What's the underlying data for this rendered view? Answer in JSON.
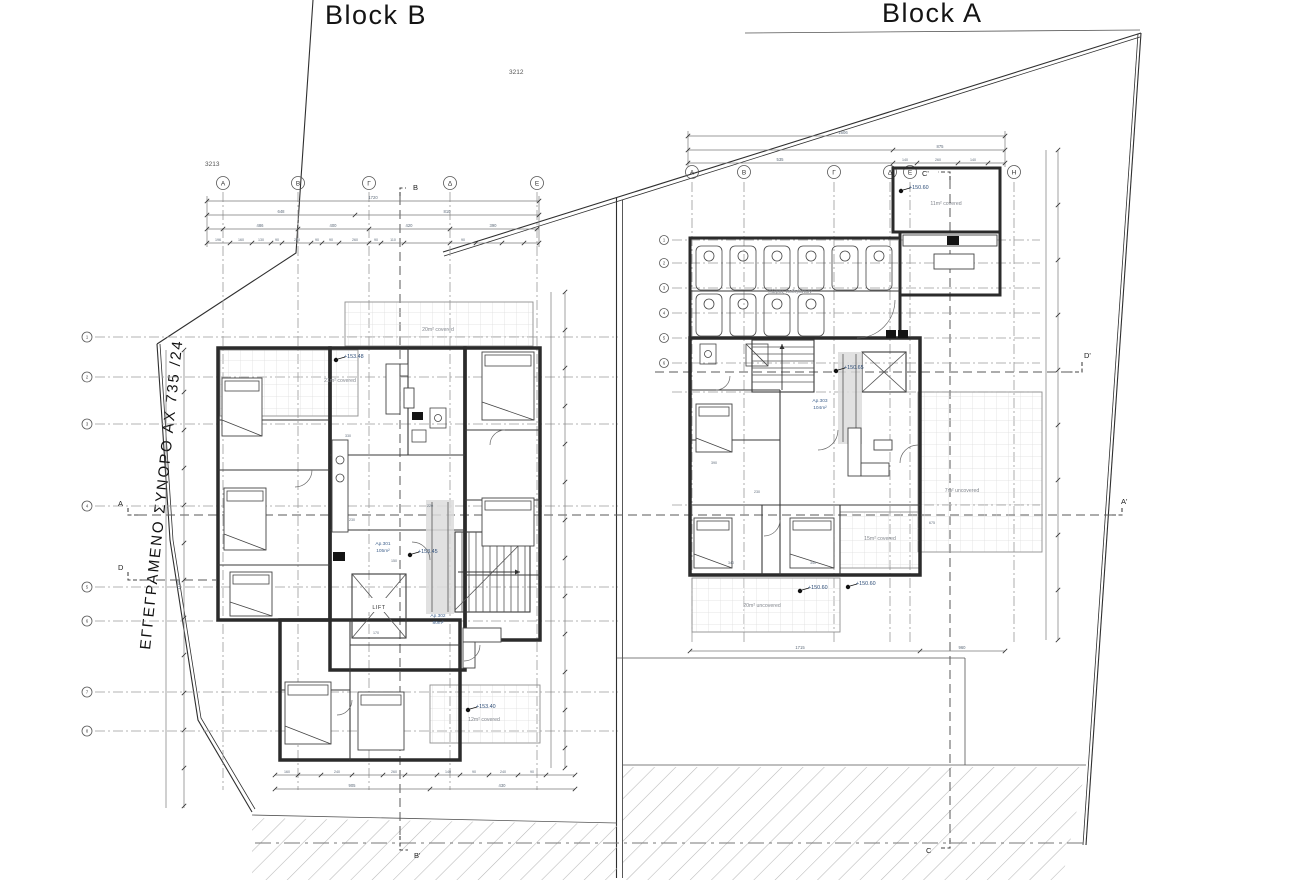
{
  "colors": {
    "paper": "#ffffff",
    "wall": "#2b2b2b",
    "grid_line": "#9a9a9a",
    "tile_line": "#dcdcdc",
    "road_hatch": "#b8b8b8",
    "dim_text": "#5f6c7b",
    "annotation_blue": "#2e4d77",
    "area_text": "#82868d"
  },
  "titles": {
    "block_b": "Block B",
    "block_a": "Block A"
  },
  "survey": {
    "p1": "3212",
    "p2": "3213"
  },
  "site": {
    "boundary_label": "ΕΓΓΕΓΡΑΜΕΝΟ ΣΥΝΟΡΟ ΑΧ 735 /24"
  },
  "sections": {
    "b": "B",
    "b_prime": "B'",
    "a": "A",
    "a_prime": "A'",
    "c": "C",
    "c_prime": "C'",
    "d": "D",
    "d_prime": "D'"
  },
  "block_b": {
    "grid_letters": [
      "Α",
      "Β",
      "Γ",
      "Δ",
      "Ε"
    ],
    "row_numbers": [
      "1",
      "2",
      "3",
      "4",
      "5",
      "6",
      "7",
      "8"
    ],
    "lift": "LIFT",
    "levels": {
      "balcony_top": "+153.48",
      "entry": "+153.45",
      "balcony_bottom": "+153.40"
    },
    "areas": {
      "balcony_20": "20m² covered",
      "balcony_21": "21m² covered",
      "balcony_12": "12m² covered"
    },
    "apartments": {
      "ap1_name": "Ap.301",
      "ap1_area": "105m²",
      "ap2_name": "Ap.302",
      "ap2_area": "80m²"
    },
    "dims": {
      "total": "1720",
      "row2": [
        "648",
        "810"
      ],
      "row3": [
        "486",
        "400",
        "420",
        "390"
      ],
      "row4": [
        "196",
        "160",
        "130",
        "90",
        "240",
        "90",
        "90",
        "260",
        "90",
        "110",
        "90"
      ],
      "left_total": "1148",
      "bottom": [
        "160",
        "240",
        "260",
        "140",
        "90",
        "240",
        "90"
      ],
      "bottom_totals": [
        "905",
        "430"
      ],
      "inner": [
        "230",
        "220",
        "330",
        "170",
        "150"
      ]
    }
  },
  "block_a": {
    "grid_letters": [
      "Α",
      "Β",
      "Γ",
      "Δ",
      "Ε",
      "Η"
    ],
    "row_numbers": [
      "1",
      "2",
      "3",
      "4",
      "5",
      "6"
    ],
    "storage_label": "Χώρος ποδηλάτων",
    "levels": {
      "balcony_11": "+150.60",
      "entry": "+150.65",
      "terrace_a": "+150.60",
      "terrace_b": "+150.60"
    },
    "areas": {
      "covered_11": "11m² covered",
      "covered_15": "15m² covered",
      "uncovered_20": "20m² uncovered",
      "uncovered_7": "7m² uncovered"
    },
    "apartments": {
      "ap3_name": "Ap.303",
      "ap3_area": "104m²"
    },
    "dims": {
      "total": "1606",
      "row2": [
        "875"
      ],
      "row3": [
        "535",
        "140",
        "260",
        "140"
      ],
      "bottom": [
        "1715",
        "960"
      ],
      "inner": [
        "390",
        "230",
        "340",
        "340",
        "675"
      ]
    }
  }
}
